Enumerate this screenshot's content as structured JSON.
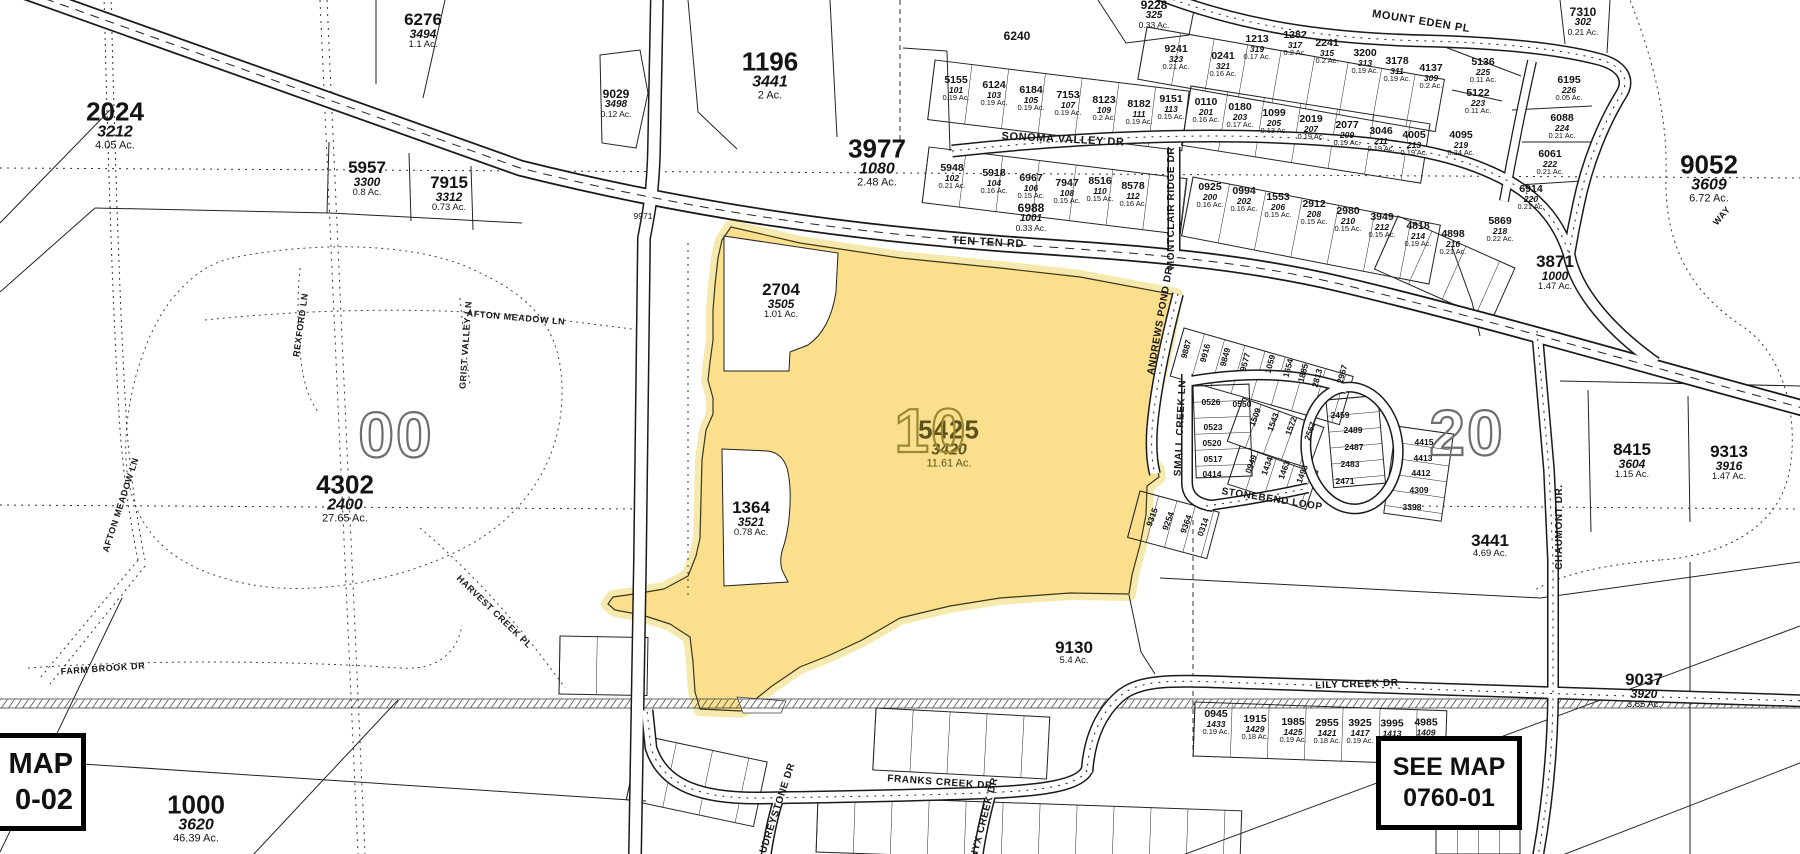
{
  "map": {
    "see_map_left": {
      "line1": "MAP",
      "line2": "0-02"
    },
    "see_map_right": {
      "line1": "SEE MAP",
      "line2": "0760-01"
    },
    "highlight_parcel": {
      "id": "5425",
      "lot": "3420",
      "area": "11.61 Ac.",
      "color": "#FBDF8C",
      "halo": "#F6E9AE",
      "label_color": "#5a531f"
    },
    "grid_numbers": [
      {
        "t": "00",
        "x": 396,
        "y": 435,
        "c": "#6e6e6e",
        "fs": 64
      },
      {
        "t": "10",
        "x": 931,
        "y": 432,
        "c": "#9a8a33",
        "fs": 62
      },
      {
        "t": "20",
        "x": 1467,
        "y": 433,
        "c": "#6e6e6e",
        "fs": 64
      }
    ],
    "parcels": [
      {
        "id": "2024",
        "lot": "3212",
        "area": "4.05 Ac.",
        "x": 115,
        "y": 125,
        "s": "sz-lg"
      },
      {
        "id": "6276",
        "lot": "3494",
        "area": "1.1 Ac.",
        "x": 423,
        "y": 30,
        "s": "sz-md"
      },
      {
        "id": "9029",
        "lot": "3498",
        "area": "0.12 Ac.",
        "x": 616,
        "y": 103,
        "s": "sz-sm"
      },
      {
        "id": "5957",
        "lot": "3300",
        "area": "0.8 Ac.",
        "x": 367,
        "y": 178,
        "s": "sz-md"
      },
      {
        "id": "7915",
        "lot": "3312",
        "area": "0.73 Ac.",
        "x": 449,
        "y": 193,
        "s": "sz-md"
      },
      {
        "id": "1196",
        "lot": "3441",
        "area": "2 Ac.",
        "x": 770,
        "y": 75,
        "s": "sz-lg"
      },
      {
        "id": "3977",
        "lot": "1080",
        "area": "2.48 Ac.",
        "x": 877,
        "y": 162,
        "s": "sz-lg"
      },
      {
        "id": "2704",
        "lot": "3505",
        "area": "1.01 Ac.",
        "x": 781,
        "y": 300,
        "s": "sz-md"
      },
      {
        "id": "1364",
        "lot": "3521",
        "area": "0.78 Ac.",
        "x": 751,
        "y": 518,
        "s": "sz-md"
      },
      {
        "id": "9052",
        "lot": "3609",
        "area": "6.72 Ac.",
        "x": 1709,
        "y": 178,
        "s": "sz-lg"
      },
      {
        "id": "3871",
        "lot": "1000",
        "area": "1.47 Ac.",
        "x": 1555,
        "y": 272,
        "s": "sz-md"
      },
      {
        "id": "8415",
        "lot": "3604",
        "area": "1.15 Ac.",
        "x": 1632,
        "y": 460,
        "s": "sz-md"
      },
      {
        "id": "9313",
        "lot": "3916",
        "area": "1.47 Ac.",
        "x": 1729,
        "y": 462,
        "s": "sz-md"
      },
      {
        "id": "3441",
        "lot": "",
        "area": "4.69 Ac.",
        "x": 1490,
        "y": 545,
        "s": "sz-md"
      },
      {
        "id": "9037",
        "lot": "3920",
        "area": "3.85 Ac.",
        "x": 1644,
        "y": 690,
        "s": "sz-md"
      },
      {
        "id": "9130",
        "lot": "",
        "area": "5.4 Ac.",
        "x": 1074,
        "y": 652,
        "s": "sz-md"
      },
      {
        "id": "1000",
        "lot": "3620",
        "area": "46.39 Ac.",
        "x": 196,
        "y": 818,
        "s": "sz-lg"
      },
      {
        "id": "4302",
        "lot": "2400",
        "area": "27.65 Ac.",
        "x": 345,
        "y": 498,
        "s": "sz-lg"
      },
      {
        "id": "6988",
        "lot": "1001",
        "area": "0.33 Ac.",
        "x": 1031,
        "y": 217,
        "s": "sz-sm"
      },
      {
        "id": "6240",
        "lot": "",
        "area": "",
        "x": 1017,
        "y": 36,
        "s": "sz-sm"
      },
      {
        "id": "9228",
        "lot": "325",
        "area": "0.33 Ac.",
        "x": 1154,
        "y": 14,
        "s": "sz-sm"
      },
      {
        "id": "7310",
        "lot": "302",
        "area": "0.21 Ac.",
        "x": 1583,
        "y": 21,
        "s": "sz-sm"
      }
    ],
    "lots": [
      {
        "id": "5155",
        "n": "101",
        "a": "0.19 Ac.",
        "x": 956,
        "y": 88
      },
      {
        "id": "6124",
        "n": "103",
        "a": "0.19 Ac.",
        "x": 994,
        "y": 93
      },
      {
        "id": "6184",
        "n": "105",
        "a": "0.19 Ac.",
        "x": 1031,
        "y": 98
      },
      {
        "id": "7153",
        "n": "107",
        "a": "0.19 Ac.",
        "x": 1068,
        "y": 103
      },
      {
        "id": "8123",
        "n": "109",
        "a": "0.2 Ac.",
        "x": 1104,
        "y": 108
      },
      {
        "id": "8182",
        "n": "111",
        "a": "0.19 Ac.",
        "x": 1139,
        "y": 112
      },
      {
        "id": "9151",
        "n": "113",
        "a": "0.15 Ac.",
        "x": 1171,
        "y": 107
      },
      {
        "id": "5948",
        "n": "102",
        "a": "0.21 Ac.",
        "x": 952,
        "y": 176
      },
      {
        "id": "5918",
        "n": "104",
        "a": "0.16 Ac.",
        "x": 994,
        "y": 181
      },
      {
        "id": "6967",
        "n": "106",
        "a": "0.15 Ac.",
        "x": 1031,
        "y": 186
      },
      {
        "id": "7947",
        "n": "108",
        "a": "0.15 Ac.",
        "x": 1067,
        "y": 191
      },
      {
        "id": "8516",
        "n": "110",
        "a": "0.15 Ac.",
        "x": 1100,
        "y": 189
      },
      {
        "id": "8578",
        "n": "112",
        "a": "0.16 Ac.",
        "x": 1133,
        "y": 194
      },
      {
        "id": "0110",
        "n": "201",
        "a": "0.16 Ac.",
        "x": 1206,
        "y": 110
      },
      {
        "id": "0180",
        "n": "203",
        "a": "0.17 Ac.",
        "x": 1240,
        "y": 115
      },
      {
        "id": "1099",
        "n": "205",
        "a": "0.13 Ac.",
        "x": 1274,
        "y": 121
      },
      {
        "id": "2019",
        "n": "207",
        "a": "0.19 Ac.",
        "x": 1311,
        "y": 127
      },
      {
        "id": "2077",
        "n": "209",
        "a": "0.19 Ac.",
        "x": 1347,
        "y": 133
      },
      {
        "id": "3046",
        "n": "211",
        "a": "0.19 Ac.",
        "x": 1381,
        "y": 139
      },
      {
        "id": "4005",
        "n": "213",
        "a": "0.19 Ac.",
        "x": 1414,
        "y": 143
      },
      {
        "id": "4095",
        "n": "219",
        "a": "0.24 Ac.",
        "x": 1461,
        "y": 143
      },
      {
        "id": "0925",
        "n": "200",
        "a": "0.16 Ac.",
        "x": 1210,
        "y": 195
      },
      {
        "id": "0994",
        "n": "202",
        "a": "0.16 Ac.",
        "x": 1244,
        "y": 199
      },
      {
        "id": "1553",
        "n": "206",
        "a": "0.15 Ac.",
        "x": 1278,
        "y": 205
      },
      {
        "id": "2912",
        "n": "208",
        "a": "0.15 Ac.",
        "x": 1314,
        "y": 212
      },
      {
        "id": "2980",
        "n": "210",
        "a": "0.15 Ac.",
        "x": 1348,
        "y": 219
      },
      {
        "id": "3949",
        "n": "212",
        "a": "0.15 Ac.",
        "x": 1382,
        "y": 225
      },
      {
        "id": "4818",
        "n": "214",
        "a": "0.19 Ac.",
        "x": 1418,
        "y": 234
      },
      {
        "id": "4898",
        "n": "216",
        "a": "0.21 Ac.",
        "x": 1453,
        "y": 242
      },
      {
        "id": "5869",
        "n": "218",
        "a": "0.22 Ac.",
        "x": 1500,
        "y": 229
      },
      {
        "id": "6914",
        "n": "220",
        "a": "0.21 Ac.",
        "x": 1531,
        "y": 197
      },
      {
        "id": "9241",
        "n": "323",
        "a": "0.21 Ac.",
        "x": 1176,
        "y": 57
      },
      {
        "id": "0241",
        "n": "321",
        "a": "0.16 Ac.",
        "x": 1223,
        "y": 64
      },
      {
        "id": "1213",
        "n": "319",
        "a": "0.17 Ac.",
        "x": 1257,
        "y": 47
      },
      {
        "id": "1282",
        "n": "317",
        "a": "0.2 Ac.",
        "x": 1295,
        "y": 43
      },
      {
        "id": "2241",
        "n": "315",
        "a": "0.2 Ac.",
        "x": 1327,
        "y": 51
      },
      {
        "id": "3200",
        "n": "313",
        "a": "0.19 Ac.",
        "x": 1365,
        "y": 61
      },
      {
        "id": "3178",
        "n": "311",
        "a": "0.19 Ac.",
        "x": 1397,
        "y": 69
      },
      {
        "id": "4137",
        "n": "309",
        "a": "0.2 Ac.",
        "x": 1431,
        "y": 76
      },
      {
        "id": "5136",
        "n": "225",
        "a": "0.11 Ac.",
        "x": 1483,
        "y": 70
      },
      {
        "id": "5122",
        "n": "223",
        "a": "0.11 Ac.",
        "x": 1478,
        "y": 101
      },
      {
        "id": "6195",
        "n": "226",
        "a": "0.05 Ac.",
        "x": 1569,
        "y": 88
      },
      {
        "id": "6088",
        "n": "224",
        "a": "0.21 Ac.",
        "x": 1562,
        "y": 126
      },
      {
        "id": "6061",
        "n": "222",
        "a": "0.21 Ac.",
        "x": 1550,
        "y": 162
      },
      {
        "id": "0945",
        "n": "1433",
        "a": "0.19 Ac.",
        "x": 1216,
        "y": 722
      },
      {
        "id": "1915",
        "n": "1429",
        "a": "0.18 Ac.",
        "x": 1255,
        "y": 727
      },
      {
        "id": "1985",
        "n": "1425",
        "a": "0.19 Ac.",
        "x": 1293,
        "y": 730
      },
      {
        "id": "2955",
        "n": "1421",
        "a": "0.18 Ac.",
        "x": 1327,
        "y": 731
      },
      {
        "id": "3925",
        "n": "1417",
        "a": "0.19 Ac.",
        "x": 1360,
        "y": 731
      },
      {
        "id": "3995",
        "n": "1413",
        "a": "",
        "x": 1392,
        "y": 728
      },
      {
        "id": "4985",
        "n": "1409",
        "a": "",
        "x": 1426,
        "y": 727
      }
    ],
    "block_lots": [
      {
        "t": "9887",
        "x": 1186,
        "y": 349,
        "r": -75
      },
      {
        "t": "9916",
        "x": 1205,
        "y": 353,
        "r": -75
      },
      {
        "t": "9849",
        "x": 1225,
        "y": 357,
        "r": -75
      },
      {
        "t": "9577",
        "x": 1245,
        "y": 362,
        "r": -75
      },
      {
        "t": "1059",
        "x": 1270,
        "y": 364,
        "r": -75
      },
      {
        "t": "1654",
        "x": 1288,
        "y": 368,
        "r": -75
      },
      {
        "t": "1885",
        "x": 1303,
        "y": 373,
        "r": -75
      },
      {
        "t": "2813",
        "x": 1317,
        "y": 378,
        "r": -75
      },
      {
        "t": "2967",
        "x": 1342,
        "y": 374,
        "r": -75
      },
      {
        "t": "1509",
        "x": 1255,
        "y": 417,
        "r": -70
      },
      {
        "t": "1543",
        "x": 1273,
        "y": 422,
        "r": -70
      },
      {
        "t": "1572",
        "x": 1291,
        "y": 426,
        "r": -70
      },
      {
        "t": "2567",
        "x": 1310,
        "y": 431,
        "r": -70
      },
      {
        "t": "0949",
        "x": 1251,
        "y": 464,
        "r": -70
      },
      {
        "t": "1434",
        "x": 1267,
        "y": 466,
        "r": -70
      },
      {
        "t": "1463",
        "x": 1284,
        "y": 470,
        "r": -70
      },
      {
        "t": "1493",
        "x": 1302,
        "y": 474,
        "r": -70
      },
      {
        "t": "9315",
        "x": 1152,
        "y": 517,
        "r": -70
      },
      {
        "t": "9254",
        "x": 1168,
        "y": 521,
        "r": -70
      },
      {
        "t": "9364",
        "x": 1186,
        "y": 524,
        "r": -70
      },
      {
        "t": "0314",
        "x": 1203,
        "y": 527,
        "r": -70
      },
      {
        "t": "0526",
        "x": 1211,
        "y": 402,
        "r": 0
      },
      {
        "t": "0550",
        "x": 1242,
        "y": 404,
        "r": 0
      },
      {
        "t": "0523",
        "x": 1213,
        "y": 427,
        "r": 0
      },
      {
        "t": "0520",
        "x": 1212,
        "y": 443,
        "r": 0
      },
      {
        "t": "0517",
        "x": 1213,
        "y": 459,
        "r": 0
      },
      {
        "t": "0414",
        "x": 1212,
        "y": 474,
        "r": 0
      },
      {
        "t": "2459",
        "x": 1340,
        "y": 415,
        "r": 0
      },
      {
        "t": "2489",
        "x": 1353,
        "y": 430,
        "r": 0
      },
      {
        "t": "2487",
        "x": 1354,
        "y": 447,
        "r": 0
      },
      {
        "t": "2483",
        "x": 1350,
        "y": 464,
        "r": 0
      },
      {
        "t": "2471",
        "x": 1345,
        "y": 481,
        "r": 0
      },
      {
        "t": "4415",
        "x": 1424,
        "y": 442,
        "r": 0
      },
      {
        "t": "4413",
        "x": 1423,
        "y": 458,
        "r": 0
      },
      {
        "t": "4412",
        "x": 1421,
        "y": 473,
        "r": 0
      },
      {
        "t": "4309",
        "x": 1419,
        "y": 490,
        "r": 0
      },
      {
        "t": "3398",
        "x": 1412,
        "y": 507,
        "r": 0
      }
    ],
    "streets": [
      {
        "t": "TEN TEN RD",
        "x": 988,
        "y": 243,
        "r": 3,
        "fs": 11
      },
      {
        "t": "SONOMA VALLEY DR",
        "x": 1063,
        "y": 140,
        "r": 3,
        "fs": 11
      },
      {
        "t": "MOUNT EDEN PL",
        "x": 1421,
        "y": 22,
        "r": 9,
        "fs": 11
      },
      {
        "t": "MONTCLAIR RIDGE DR",
        "x": 1172,
        "y": 208,
        "r": -90,
        "fs": 10
      },
      {
        "t": "ANDREWS POND DR",
        "x": 1161,
        "y": 321,
        "r": -80,
        "fs": 10
      },
      {
        "t": "SMALL CREEK LN",
        "x": 1181,
        "y": 428,
        "r": -87,
        "fs": 10
      },
      {
        "t": "STONEBEND LOOP",
        "x": 1272,
        "y": 500,
        "r": 9,
        "fs": 10
      },
      {
        "t": "CHAUMONT DR.",
        "x": 1560,
        "y": 527,
        "r": -90,
        "fs": 10
      },
      {
        "t": "LILY CREEK DR",
        "x": 1357,
        "y": 685,
        "r": -2,
        "fs": 10
      },
      {
        "t": "FRANKS CREEK DR",
        "x": 940,
        "y": 783,
        "r": 4,
        "fs": 10
      },
      {
        "t": "AUDREYSTONE DR",
        "x": 777,
        "y": 812,
        "r": -72,
        "fs": 10
      },
      {
        "t": "ONYX CREEK DR",
        "x": 984,
        "y": 822,
        "r": -75,
        "fs": 10
      },
      {
        "t": "FARM BROOK DR",
        "x": 103,
        "y": 669,
        "r": -4,
        "fs": 9
      },
      {
        "t": "HARVEST CREEK PL",
        "x": 494,
        "y": 612,
        "r": 44,
        "fs": 9
      },
      {
        "t": "REXFORD LN",
        "x": 301,
        "y": 325,
        "r": -82,
        "fs": 9
      },
      {
        "t": "GRIST VALLEY LN",
        "x": 466,
        "y": 345,
        "r": -86,
        "fs": 9
      },
      {
        "t": "AFTON MEADOW LN",
        "x": 516,
        "y": 318,
        "r": 5,
        "fs": 9
      },
      {
        "t": "AFTON MEADOW LN",
        "x": 121,
        "y": 505,
        "r": -72,
        "fs": 9
      },
      {
        "t": "WAY",
        "x": 1722,
        "y": 216,
        "r": -50,
        "fs": 9
      }
    ],
    "texts": [
      {
        "t": "9971",
        "x": 643,
        "y": 216
      }
    ]
  }
}
